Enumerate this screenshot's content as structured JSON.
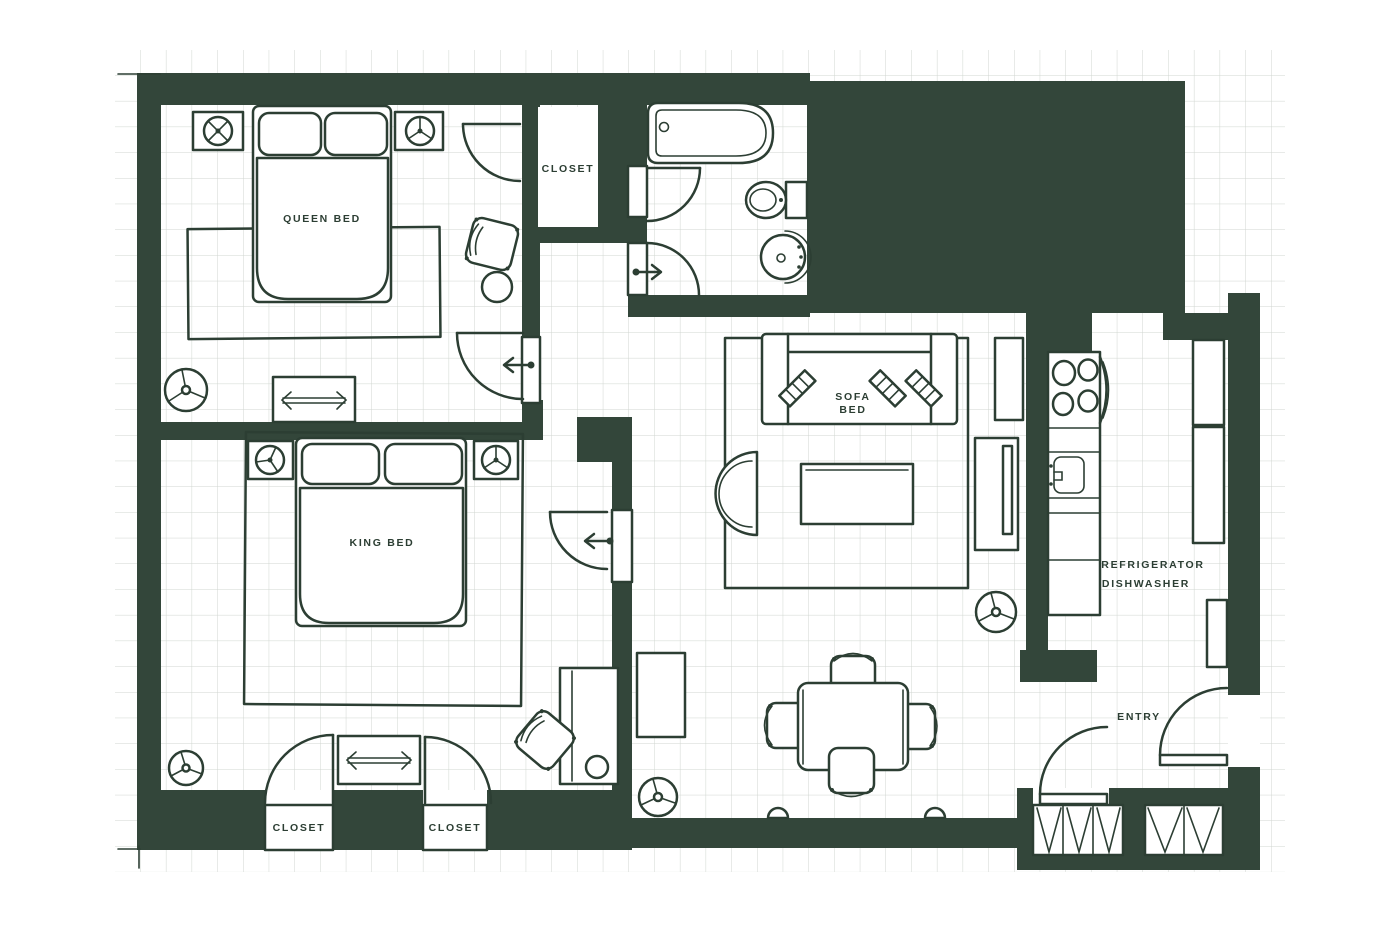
{
  "plan": {
    "title": "two-bedroom apartment floor plan",
    "colors": {
      "wall": "#33463a",
      "ink": "#2c3e33",
      "grid": "#d0d6d0",
      "paper": "#ffffff"
    },
    "labels": {
      "queen_bed": "QUEEN BED",
      "king_bed": "KING BED",
      "sofa_line1": "SOFA",
      "sofa_line2": "BED",
      "closet_hall": "CLOSET",
      "closet_king_left": "CLOSET",
      "closet_king_right": "CLOSET",
      "refrigerator": "REFRIGERATOR",
      "dishwasher": "DISHWASHER",
      "entry": "ENTRY"
    }
  }
}
